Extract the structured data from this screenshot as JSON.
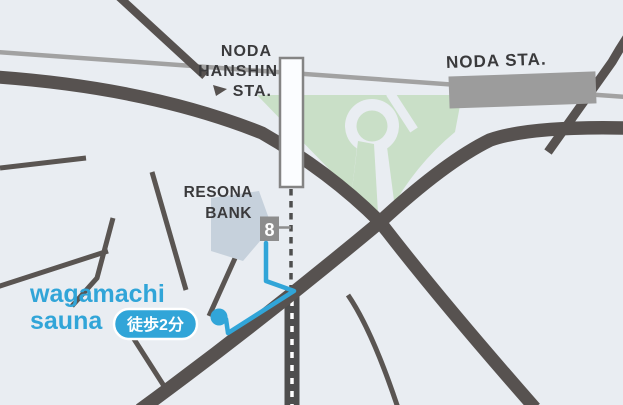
{
  "map": {
    "title": "wagamachi sauna access map",
    "stations": {
      "noda_hanshin": {
        "line1": "NODA",
        "line2": "HANSHIN",
        "line3": "STA."
      },
      "noda_jr": {
        "label": "NODA STA."
      }
    },
    "landmarks": {
      "bank": {
        "line1": "RESONA",
        "line2": "BANK"
      }
    },
    "exit": {
      "number": "8"
    },
    "venue": {
      "name_line1": "wagamachi",
      "name_line2": "sauna",
      "walk_badge": "徒歩2分"
    },
    "route": {
      "walk_minutes": 2,
      "from_exit": "8"
    },
    "colors": {
      "background": "#e9edf2",
      "road": "#575250",
      "railway_gray": "#a2a2a2",
      "railway_dark": "#4e4e4e",
      "park_green": "#c9dfc7",
      "bank_building": "#c6d1dc",
      "station_box_gray": "#9c9c9c",
      "brand_blue": "#31a5d8",
      "label_dark": "#3a3a3c",
      "exit_box_gray": "#8d8d8d"
    },
    "icons": {
      "destination": "location-dot-icon"
    }
  }
}
